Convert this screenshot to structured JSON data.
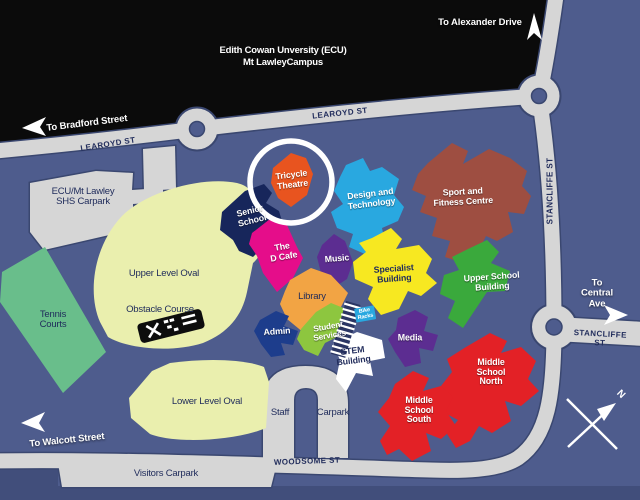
{
  "title": {
    "text": "Edith Cowan Unversity (ECU)\nMt LawleyCampus"
  },
  "directions": {
    "alexander": "To Alexander Drive",
    "bradford": "To Bradford Street",
    "central": "To Central Ave",
    "walcott": "To Walcott Street"
  },
  "streets": {
    "learoyd": "LEAROYD ST",
    "stancliffe": "STANCLIFFE ST",
    "woodsome": "WOODSOME ST"
  },
  "areas": {
    "ecu_carpark": "ECU/Mt Lawley\nSHS Carpark",
    "tennis": "Tennis\nCourts",
    "upper_oval": "Upper Level Oval",
    "obstacle": "Obstacle Course",
    "lower_oval": "Lower Level Oval",
    "visitors": "Visitors Carpark",
    "staff": "Staff",
    "carpark": "Carpark"
  },
  "buildings": {
    "senior": {
      "label": "Senior\nSchool",
      "color": "#17265B"
    },
    "tricycle": {
      "label": "Tricycle\nTheatre",
      "color": "#E8541F"
    },
    "design": {
      "label": "Design and\nTechnology",
      "color": "#29A8E0"
    },
    "sport": {
      "label": "Sport and\nFitness Centre",
      "color": "#9E4E41"
    },
    "dcafe": {
      "label": "The\nD Cafe",
      "color": "#E50D8A"
    },
    "music": {
      "label": "Music",
      "color": "#5C2D91"
    },
    "specialist": {
      "label": "Specialist\nBuilding",
      "color": "#F7E821"
    },
    "upper_school": {
      "label": "Upper School\nBuilding",
      "color": "#3AA93C"
    },
    "library": {
      "label": "Library",
      "color": "#F2A444"
    },
    "admin": {
      "label": "Admin",
      "color": "#1D3D8C"
    },
    "student": {
      "label": "Student\nServices",
      "color": "#8DC63F"
    },
    "bike": {
      "label": "Bike\nRacks",
      "color": "#29A8E0"
    },
    "stem": {
      "label": "STEM\nBuilding",
      "color": "#FFFFFF"
    },
    "media": {
      "label": "Media",
      "color": "#5C2D91"
    },
    "middle_north": {
      "label": "Middle\nSchool\nNorth",
      "color": "#E32126"
    },
    "middle_south": {
      "label": "Middle\nSchool\nSouth",
      "color": "#E32126"
    }
  },
  "compass": {
    "north": "N"
  },
  "colors": {
    "background": "#4E5C8D",
    "road": "#D6D6D6",
    "road_outline": "#3A4770",
    "header_black": "#0B0B0B",
    "dark_strip": "#414E7B",
    "tennis": "#69BE8B",
    "oval": "#EAEFAE",
    "text_dark": "#1E2A5A",
    "text_street": "#222D5C"
  }
}
